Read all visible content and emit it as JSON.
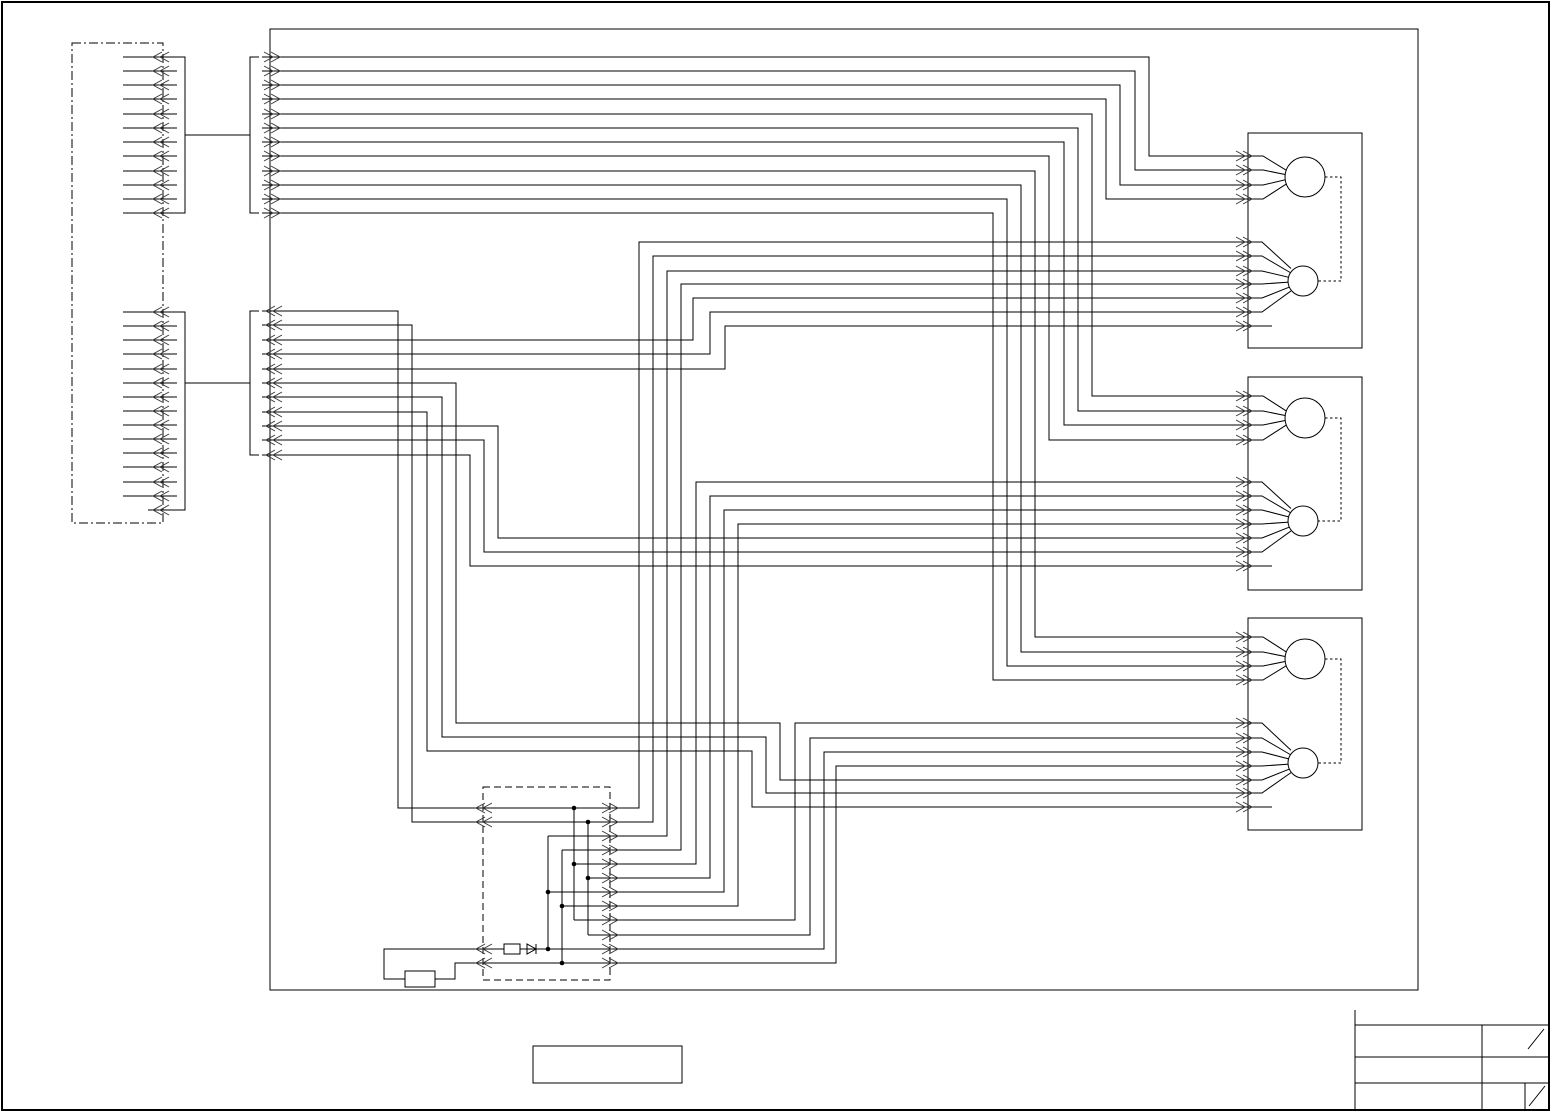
{
  "diagram": {
    "canvas": {
      "w": 1553,
      "h": 1113,
      "background": "#ffffff"
    },
    "style": {
      "line": "#000000",
      "chevron": "#3a3a3a",
      "thin": 1,
      "frame": 1.4
    },
    "frames": {
      "page_border": {
        "x": 2,
        "y": 2,
        "w": 1547,
        "h": 1108
      },
      "main_enclosure": {
        "x": 270,
        "y": 29,
        "w": 1148,
        "h": 961
      },
      "harness_box": {
        "x": 72,
        "y": 43,
        "w": 91,
        "h": 480,
        "dash": "9 3 2 3"
      },
      "junction_box": {
        "x": 483,
        "y": 787,
        "w": 127,
        "h": 193,
        "dash": "7 4"
      },
      "spare_box": {
        "x": 533,
        "y": 1046,
        "w": 149,
        "h": 37
      }
    },
    "harness_groups": [
      {
        "x1": 123,
        "x2": 177,
        "ys": [
          57,
          71,
          85,
          99,
          114,
          128,
          142,
          156,
          171,
          185,
          199,
          213
        ],
        "short_last": false
      },
      {
        "x1": 123,
        "x2": 177,
        "ys": [
          312,
          326,
          340,
          354,
          369,
          383,
          397,
          411,
          425,
          439,
          453,
          467,
          482,
          496,
          510
        ],
        "short_last": true,
        "short_x1": 148
      }
    ],
    "wires": {
      "brackets": [
        [
          [
            177,
            57
          ],
          [
            185,
            57
          ],
          [
            185,
            213
          ],
          [
            177,
            213
          ]
        ],
        [
          [
            185,
            135
          ],
          [
            250,
            135
          ]
        ],
        [
          [
            259,
            57
          ],
          [
            250,
            57
          ],
          [
            250,
            213
          ],
          [
            259,
            213
          ]
        ],
        [
          [
            177,
            312
          ],
          [
            185,
            312
          ],
          [
            185,
            510
          ],
          [
            177,
            510
          ]
        ],
        [
          [
            185,
            383
          ],
          [
            250,
            383
          ]
        ],
        [
          [
            259,
            311
          ],
          [
            250,
            311
          ],
          [
            250,
            455
          ],
          [
            259,
            455
          ]
        ]
      ],
      "group1": [
        [
          [
            262,
            57
          ],
          [
            1149,
            57
          ],
          [
            1149,
            156
          ],
          [
            1248,
            156
          ]
        ],
        [
          [
            262,
            71
          ],
          [
            1135,
            71
          ],
          [
            1135,
            170
          ],
          [
            1248,
            170
          ]
        ],
        [
          [
            262,
            85
          ],
          [
            1120,
            85
          ],
          [
            1120,
            185
          ],
          [
            1248,
            185
          ]
        ],
        [
          [
            262,
            99
          ],
          [
            1106,
            99
          ],
          [
            1106,
            199
          ],
          [
            1248,
            199
          ]
        ],
        [
          [
            262,
            114
          ],
          [
            1092,
            114
          ],
          [
            1092,
            396
          ],
          [
            1248,
            396
          ]
        ],
        [
          [
            262,
            128
          ],
          [
            1078,
            128
          ],
          [
            1078,
            411
          ],
          [
            1248,
            411
          ]
        ],
        [
          [
            262,
            142
          ],
          [
            1064,
            142
          ],
          [
            1064,
            425
          ],
          [
            1248,
            425
          ]
        ],
        [
          [
            262,
            156
          ],
          [
            1049,
            156
          ],
          [
            1049,
            440
          ],
          [
            1248,
            440
          ]
        ],
        [
          [
            262,
            171
          ],
          [
            1035,
            171
          ],
          [
            1035,
            637
          ],
          [
            1248,
            637
          ]
        ],
        [
          [
            262,
            185
          ],
          [
            1021,
            185
          ],
          [
            1021,
            652
          ],
          [
            1248,
            652
          ]
        ],
        [
          [
            262,
            199
          ],
          [
            1007,
            199
          ],
          [
            1007,
            666
          ],
          [
            1248,
            666
          ]
        ],
        [
          [
            262,
            213
          ],
          [
            993,
            213
          ],
          [
            993,
            680
          ],
          [
            1248,
            680
          ]
        ]
      ],
      "group2": [
        [
          [
            262,
            311
          ],
          [
            398,
            311
          ],
          [
            398,
            808
          ],
          [
            483,
            808
          ]
        ],
        [
          [
            262,
            325
          ],
          [
            412,
            325
          ],
          [
            412,
            822
          ],
          [
            483,
            822
          ]
        ],
        [
          [
            262,
            340
          ],
          [
            693,
            340
          ],
          [
            693,
            298
          ],
          [
            1248,
            298
          ]
        ],
        [
          [
            262,
            354
          ],
          [
            710,
            354
          ],
          [
            710,
            312
          ],
          [
            1248,
            312
          ]
        ],
        [
          [
            262,
            369
          ],
          [
            725,
            369
          ],
          [
            725,
            326
          ],
          [
            1248,
            326
          ]
        ],
        [
          [
            262,
            383
          ],
          [
            456,
            383
          ],
          [
            456,
            723
          ],
          [
            780,
            723
          ],
          [
            780,
            780
          ],
          [
            1248,
            780
          ]
        ],
        [
          [
            262,
            397
          ],
          [
            442,
            397
          ],
          [
            442,
            737
          ],
          [
            766,
            737
          ],
          [
            766,
            793
          ],
          [
            1248,
            793
          ]
        ],
        [
          [
            262,
            412
          ],
          [
            427,
            412
          ],
          [
            427,
            751
          ],
          [
            752,
            751
          ],
          [
            752,
            807
          ],
          [
            1248,
            807
          ]
        ],
        [
          [
            262,
            426
          ],
          [
            498,
            426
          ],
          [
            498,
            538
          ],
          [
            1248,
            538
          ]
        ],
        [
          [
            262,
            440
          ],
          [
            484,
            440
          ],
          [
            484,
            552
          ],
          [
            1248,
            552
          ]
        ],
        [
          [
            262,
            455
          ],
          [
            470,
            455
          ],
          [
            470,
            566
          ],
          [
            1248,
            566
          ]
        ]
      ],
      "junction_out": [
        [
          [
            483,
            808
          ],
          [
            639,
            808
          ],
          [
            639,
            242
          ],
          [
            1248,
            242
          ]
        ],
        [
          [
            483,
            822
          ],
          [
            653,
            822
          ],
          [
            653,
            256
          ],
          [
            1248,
            256
          ]
        ],
        [
          [
            548,
            836
          ],
          [
            667,
            836
          ],
          [
            667,
            271
          ],
          [
            1248,
            271
          ]
        ],
        [
          [
            562,
            850
          ],
          [
            681,
            850
          ],
          [
            681,
            284
          ],
          [
            1248,
            284
          ]
        ],
        [
          [
            574,
            864
          ],
          [
            696,
            864
          ],
          [
            696,
            482
          ],
          [
            1248,
            482
          ]
        ],
        [
          [
            588,
            878
          ],
          [
            710,
            878
          ],
          [
            710,
            496
          ],
          [
            1248,
            496
          ]
        ],
        [
          [
            548,
            892
          ],
          [
            724,
            892
          ],
          [
            724,
            510
          ],
          [
            1248,
            510
          ]
        ],
        [
          [
            562,
            906
          ],
          [
            738,
            906
          ],
          [
            738,
            524
          ],
          [
            1248,
            524
          ]
        ],
        [
          [
            574,
            920
          ],
          [
            795,
            920
          ],
          [
            795,
            723
          ],
          [
            1248,
            723
          ]
        ],
        [
          [
            588,
            935
          ],
          [
            810,
            935
          ],
          [
            810,
            738
          ],
          [
            1248,
            738
          ]
        ],
        [
          [
            483,
            949
          ],
          [
            824,
            949
          ],
          [
            824,
            752
          ],
          [
            1248,
            752
          ]
        ],
        [
          [
            483,
            963
          ],
          [
            836,
            963
          ],
          [
            836,
            766
          ],
          [
            1248,
            766
          ]
        ]
      ],
      "junction_risers": [
        [
          [
            574,
            808
          ],
          [
            574,
            920
          ]
        ],
        [
          [
            588,
            822
          ],
          [
            588,
            935
          ]
        ],
        [
          [
            548,
            836
          ],
          [
            548,
            949
          ]
        ],
        [
          [
            562,
            850
          ],
          [
            562,
            963
          ]
        ]
      ],
      "sensor_loop": [
        [
          [
            483,
            949
          ],
          [
            384,
            949
          ],
          [
            384,
            979
          ],
          [
            405,
            979
          ]
        ],
        [
          [
            435,
            979
          ],
          [
            455,
            979
          ],
          [
            455,
            963
          ],
          [
            483,
            963
          ]
        ]
      ]
    },
    "junction_dots": [
      [
        574,
        808
      ],
      [
        588,
        822
      ],
      [
        574,
        864
      ],
      [
        588,
        878
      ],
      [
        548,
        892
      ],
      [
        562,
        906
      ],
      [
        548,
        949
      ],
      [
        562,
        963
      ]
    ],
    "components": {
      "resistor": {
        "x": 504,
        "y": 944,
        "w": 16,
        "h": 10
      },
      "diode": {
        "tri": [
          [
            527,
            944
          ],
          [
            527,
            954
          ],
          [
            536,
            949
          ]
        ],
        "bar": [
          [
            536,
            944
          ],
          [
            536,
            954
          ]
        ]
      },
      "sensor_rect": {
        "x": 405,
        "y": 971,
        "w": 30,
        "h": 16
      }
    },
    "devices": [
      {
        "box": {
          "x": 1248,
          "y": 133,
          "w": 114,
          "h": 215
        },
        "big_ys": [
          156,
          170,
          185,
          199
        ],
        "small_ys": [
          242,
          256,
          271,
          284,
          298,
          312,
          326
        ],
        "big": [
          1305,
          177,
          20
        ],
        "small": [
          1303,
          281,
          15
        ],
        "link_x": 1341
      },
      {
        "box": {
          "x": 1248,
          "y": 377,
          "w": 114,
          "h": 213
        },
        "big_ys": [
          396,
          411,
          425,
          440
        ],
        "small_ys": [
          482,
          496,
          510,
          524,
          538,
          552,
          566
        ],
        "big": [
          1305,
          418,
          20
        ],
        "small": [
          1303,
          521,
          15
        ],
        "link_x": 1341
      },
      {
        "box": {
          "x": 1248,
          "y": 618,
          "w": 114,
          "h": 212
        },
        "big_ys": [
          637,
          652,
          666,
          680
        ],
        "small_ys": [
          723,
          738,
          752,
          766,
          780,
          793,
          807
        ],
        "big": [
          1305,
          659,
          20
        ],
        "small": [
          1303,
          763,
          15
        ],
        "link_x": 1341
      }
    ],
    "chevron_groups": [
      {
        "x": 160,
        "dir": "left",
        "ys": [
          57,
          71,
          85,
          99,
          114,
          128,
          142,
          156,
          171,
          185,
          199,
          213
        ]
      },
      {
        "x": 160,
        "dir": "left",
        "ys": [
          312,
          326,
          340,
          354,
          369,
          383,
          397,
          411,
          425,
          439,
          453,
          467,
          482,
          496,
          510
        ]
      },
      {
        "x": 273,
        "dir": "right",
        "ys": [
          57,
          71,
          85,
          99,
          114,
          128,
          142,
          156,
          171,
          185,
          199,
          213
        ]
      },
      {
        "x": 273,
        "dir": "left",
        "ys": [
          311,
          325,
          340,
          354,
          369,
          383,
          397,
          412,
          426,
          440,
          455
        ]
      },
      {
        "x": 483,
        "dir": "left",
        "ys": [
          808,
          822,
          949,
          963
        ]
      },
      {
        "x": 611,
        "dir": "right",
        "ys": [
          808,
          822,
          836,
          850,
          864,
          878,
          892,
          906,
          920,
          935,
          949,
          963
        ]
      },
      {
        "x": 1245,
        "dir": "right",
        "ys": [
          156,
          170,
          185,
          199,
          242,
          256,
          271,
          284,
          298,
          312,
          326
        ]
      },
      {
        "x": 1245,
        "dir": "right",
        "ys": [
          396,
          411,
          425,
          440,
          482,
          496,
          510,
          524,
          538,
          552,
          566
        ]
      },
      {
        "x": 1245,
        "dir": "right",
        "ys": [
          637,
          652,
          666,
          680,
          723,
          738,
          752,
          766,
          780,
          793,
          807
        ]
      }
    ],
    "title_block": {
      "lines": [
        [
          [
            1355,
            1010
          ],
          [
            1355,
            1110
          ]
        ],
        [
          [
            1355,
            1025
          ],
          [
            1548,
            1025
          ]
        ],
        [
          [
            1355,
            1057
          ],
          [
            1548,
            1057
          ]
        ],
        [
          [
            1355,
            1083
          ],
          [
            1548,
            1083
          ]
        ],
        [
          [
            1482,
            1025
          ],
          [
            1482,
            1110
          ]
        ],
        [
          [
            1525,
            1083
          ],
          [
            1525,
            1110
          ]
        ]
      ],
      "slashes": [
        [
          [
            1528,
            1049
          ],
          [
            1544,
            1029
          ]
        ],
        [
          [
            1529,
            1106
          ],
          [
            1545,
            1086
          ]
        ]
      ]
    }
  }
}
